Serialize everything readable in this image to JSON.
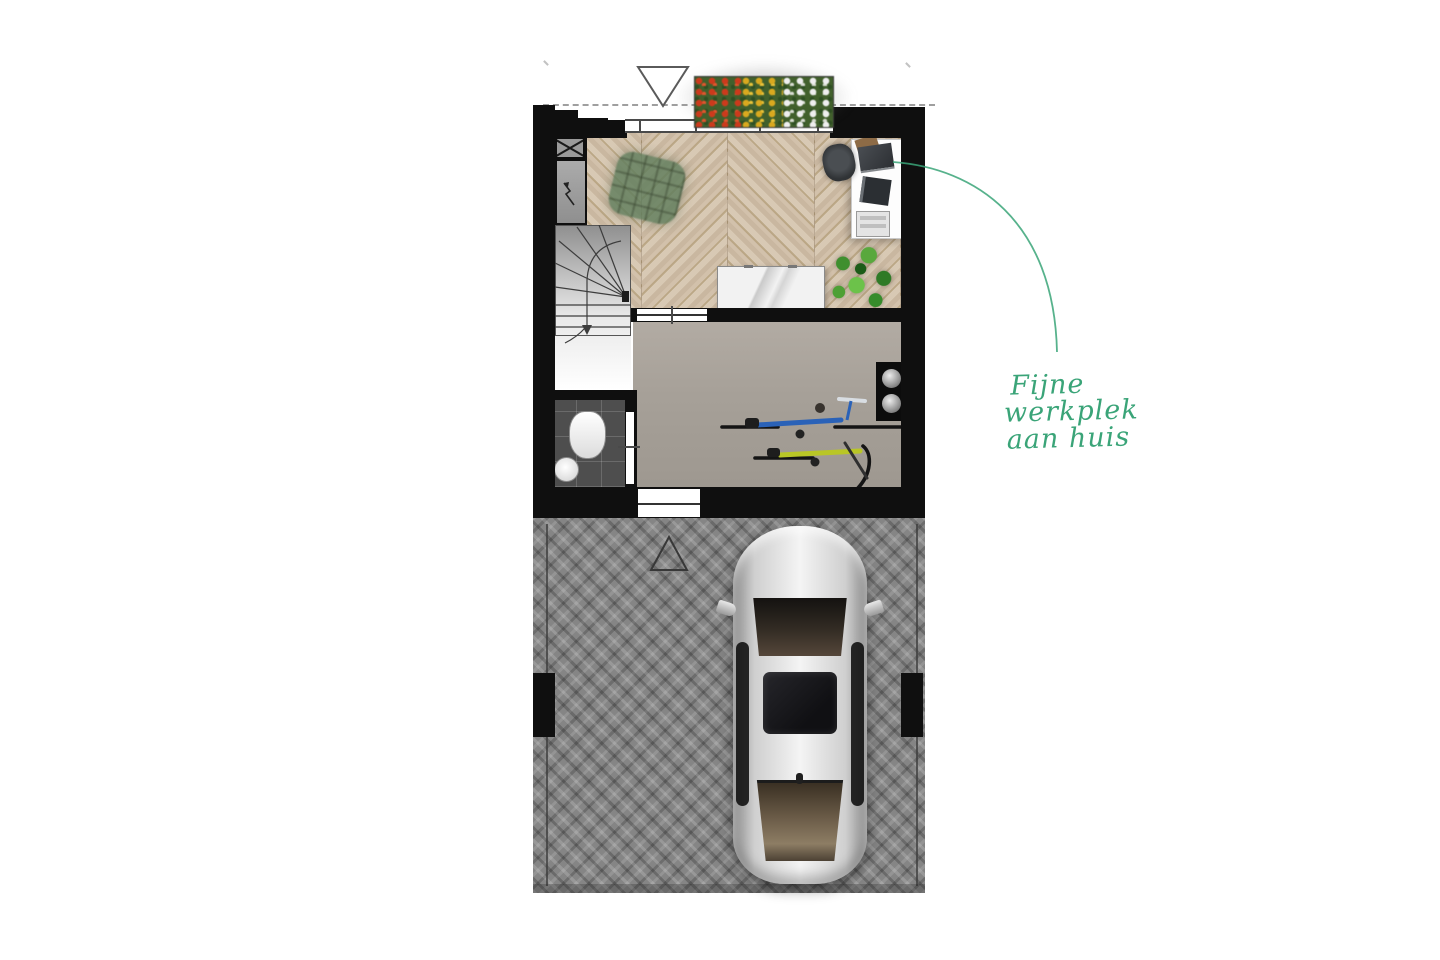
{
  "canvas": {
    "width": 1440,
    "height": 960,
    "background": "#ffffff"
  },
  "annotation": {
    "lines": [
      "Fijne",
      "werkplek",
      "aan huis"
    ],
    "full_text": "Fijne werkplek aan huis",
    "color": "#3aa478",
    "connector": "curved-leader-line",
    "points_to": "desk-workspace"
  },
  "floorplan": {
    "type": "ground-floor-plan-top-view",
    "rooms": [
      {
        "name": "study-workspace",
        "floor": "chevron-parquet",
        "items": [
          "lounge-chair",
          "desk",
          "office-chair",
          "laptop",
          "tablet",
          "printer",
          "sideboard",
          "plant",
          "flower-planter",
          "front-window"
        ]
      },
      {
        "name": "storage-garage",
        "floor": "concrete",
        "items": [
          "bicycle-blue",
          "bicycle-yellow",
          "wall-heating-unit"
        ]
      },
      {
        "name": "toilet",
        "floor": "dark-tiles",
        "items": [
          "toilet-bowl",
          "washbasin"
        ]
      },
      {
        "name": "stairwell",
        "items": [
          "winder-staircase",
          "walk-line-arrow"
        ]
      },
      {
        "name": "driveway",
        "floor": "herringbone-paving",
        "items": [
          "car",
          "entrance-marker-triangle",
          "boundary-lines"
        ]
      }
    ],
    "markers": {
      "front_entrance": "triangle-outline-down",
      "rear_entrance": "triangle-outline-up",
      "roof_overhang": "dashed-line",
      "meter_cupboard": "box-with-x-symbol"
    },
    "palette": {
      "wall": "#0f0f0f",
      "wood_floor": "#cdbba5",
      "concrete_floor": "#a8a29a",
      "tile_floor": "#4e4e4e",
      "paving": "#858585",
      "accent_green": "#3aa478",
      "bike_blue": "#2a62b8",
      "bike_yellow": "#b9c626",
      "flower_red": "#cc3a1c",
      "flower_yellow": "#d9a91f",
      "flower_white": "#efefef",
      "car_body": "#d6d6d6"
    }
  }
}
